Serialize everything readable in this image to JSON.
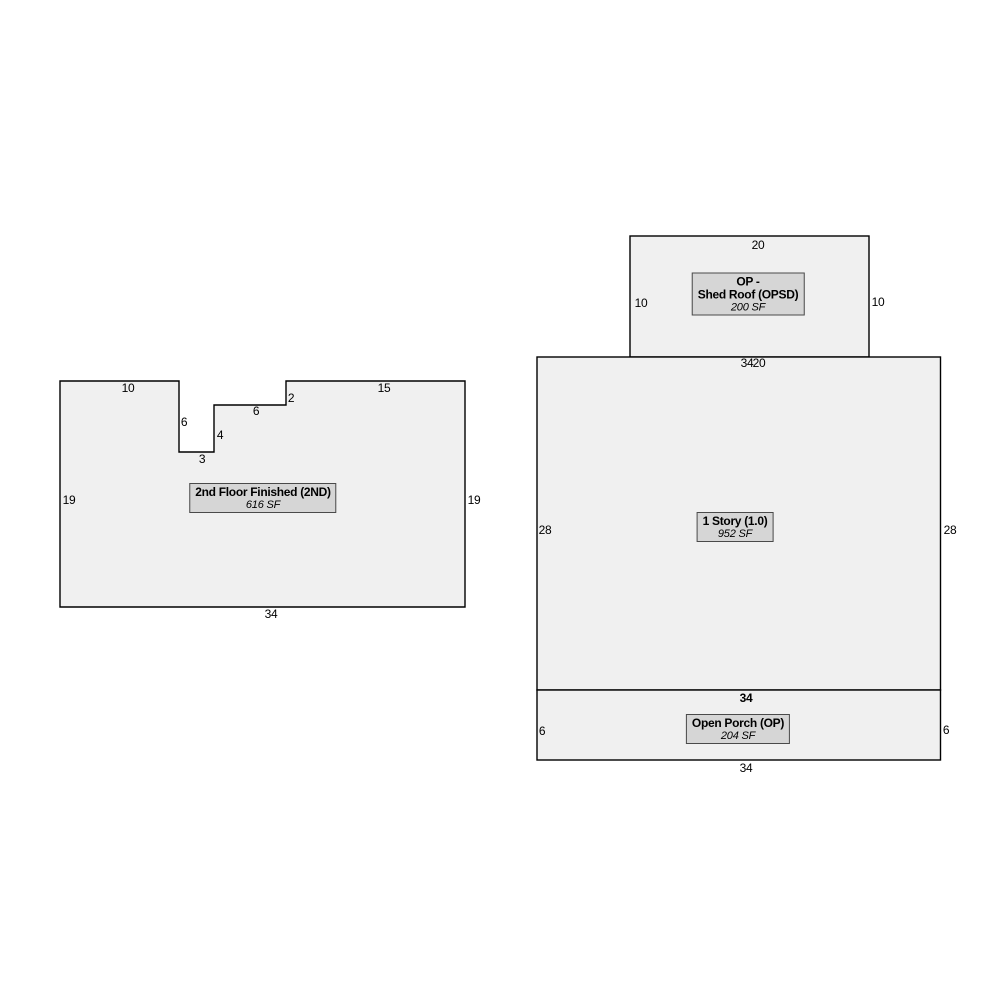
{
  "colors": {
    "background": "#ffffff",
    "shape_fill": "#f0f0f0",
    "shape_stroke": "#000000",
    "label_box_fill": "#d6d6d6",
    "label_box_border": "#4a4a4a",
    "text": "#000000"
  },
  "sketch": {
    "second_floor": {
      "label": {
        "line1": "2nd Floor Finished (2ND)",
        "line2": "616 SF"
      },
      "dims": {
        "top_left": "10",
        "notch_left": "6",
        "notch_bottom": "3",
        "notch_right": "4",
        "notch_top": "6",
        "notch_step": "2",
        "top_right": "15",
        "left": "19",
        "right": "19",
        "bottom": "34"
      }
    },
    "shed_roof": {
      "label": {
        "line1": "OP -",
        "line2": "Shed Roof (OPSD)",
        "line3": "200 SF"
      },
      "dims": {
        "top": "20",
        "left": "10",
        "right": "10",
        "bottom": "20"
      }
    },
    "one_story": {
      "label": {
        "line1": "1 Story (1.0)",
        "line2": "952 SF"
      },
      "dims": {
        "top": "34",
        "left": "28",
        "right": "28",
        "bottom": "34"
      }
    },
    "open_porch": {
      "label": {
        "line1": "Open Porch (OP)",
        "line2": "204 SF"
      },
      "dims": {
        "left": "6",
        "right": "6",
        "bottom": "34"
      }
    }
  }
}
